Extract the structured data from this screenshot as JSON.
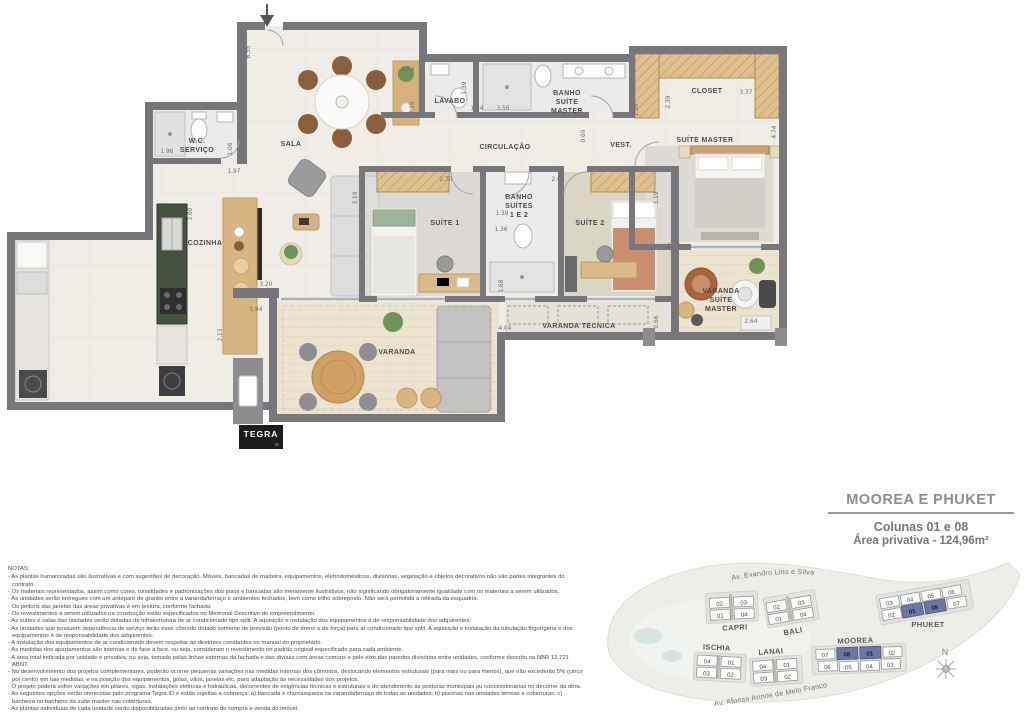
{
  "plan": {
    "labels": {
      "sala": "SALA",
      "wc1": "W.C.",
      "wc2": "SERVIÇO",
      "cozinha": "COZINHA",
      "lavabo": "LAVABO",
      "bm1": "BANHO",
      "bm2": "SUÍTE",
      "bm3": "MASTER",
      "closet": "CLOSET",
      "circ": "CIRCULAÇÃO",
      "vest": "VEST.",
      "sm": "SUÍTE MASTER",
      "s1": "SUÍTE 1",
      "s2": "SUÍTE 2",
      "bs1": "BANHO",
      "bs2": "SUÍTES",
      "bs3": "1 E 2",
      "varanda": "VARANDA",
      "vtec": "VARANDA TÉCNICA",
      "vsm1": "VARANDA",
      "vsm2": "SUÍTE",
      "vsm3": "MASTER"
    },
    "dims": [
      "6.35",
      "4.54",
      "2.39",
      "1.39",
      "1.34",
      "3.56",
      "1.36",
      "2.39",
      "3.37",
      "4.74",
      "1.96",
      "1.06",
      "1.97",
      "2.70",
      "2.69",
      "0.69",
      "3.19",
      "3.19",
      "1.39",
      "1.36",
      "1.68",
      "2.77",
      "3.60",
      "3.20",
      "5.94",
      "2.13",
      "1.84",
      "4.04",
      "0.66",
      "1.60",
      "2.64"
    ]
  },
  "logo": {
    "name": "TEGRA",
    "sub": "ID"
  },
  "title_block": {
    "title": "MOOREA E PHUKET",
    "line1": "Colunas 01 e 08",
    "line2": "Área privativa - 124,96m²"
  },
  "notes": {
    "heading": "NOTAS:",
    "items": [
      "- As plantas humanizadas são ilustrativas e com sugestões de decoração. Móveis, bancadas de madeira, equipamentos, eletrodomésticos, divisórias, vegetação e objetos decorativos não são partes integrantes do contrato.",
      "- Os materiais representados, assim como cores, tonalidades e padronizações dos pisos e bancadas são meramente ilustrativos, não significando obrigatoriamente igualdade com os materiais a serem utilizados.",
      "- As unidades serão entregues com um anteparo de granito entre a varanda/terraço e ambientes fechados, bem como trilho sobreposto. Não será permitida a retirada da esquadria.",
      "- Os peitoris das janelas das áreas privativas é em textura, conforme fachada.",
      "- Os revestimentos a serem utilizados na construção estão especificados no Memorial Descritivo do empreendimento.",
      "- As suítes e salas das unidades serão dotadas de infraestrutura de ar condicionado tipo split. A aquisição e instalação dos equipamentos é de responsabilidade dos adquirentes.",
      "- As unidades que possuem dependência de serviço terão esse cômodo dotado somente de previsão (ponto de dreno e de força) para ar condicionado tipo split. A aquisição e instalação da tubulação frigorígena e dos equipamentos é de responsabilidade dos adquirentes.",
      "- A instalação dos equipamentos de ar condicionado devem respeitar as diretrizes constantes no manual do proprietário.",
      "- As medidas dos apartamentos são internas e de face a face, ou seja, consideram o revestimento no padrão original especificado para cada ambiente.",
      "- A área total indicada por unidade é privativa, ou seja, tomada pelas linhas externas da fachada e das divisas com áreas comuns e pelo eixo das paredes divisórias entre unidades, conforme descrito na NBR 12.721 ABNT.",
      "- No desenvolvimento dos projetos complementares, poderão ocorrer pequenas variações nas medidas internas dos cômodos, deslocando elementos estruturais (para mais ou para menos), que não excederão 5% (cinco por cento) em tais medidas, e na posição dos equipamentos, golas, vãos, janelas etc, para adaptação às necessidades dos projetos.",
      "- O projeto poderá sofrer variações em pilares, vigas, instalações elétricas e hidráulicas, decorrentes de exigências técnicas e estruturais e do atendimento às posturas municipais ou concessionárias no decorrer da obra.",
      "- As seguintes opções serão oferecidas pelo programa Tegra ID e estão sujeitas a cobrança: a) bancada e churrasqueira na varanda/terraço de todas as unidades; b) piscinas nas unidades térreas e coberturas; c) banheira no banheiro da suíte master nas coberturas.",
      "- As plantas individuais de cada unidade serão disponibilizadas junto ao contrato de compra e venda do imóvel."
    ]
  },
  "map": {
    "street_top": "Av. Evandro Lins e Silva",
    "street_bottom": "Av. Afonso Arinos de Melo Franco",
    "compass": "N",
    "buildings": {
      "capri": {
        "name": "CAPRI",
        "units": [
          "02",
          "03",
          "01",
          "04"
        ]
      },
      "bali": {
        "name": "BALI",
        "units": [
          "02",
          "03",
          "01",
          "04"
        ]
      },
      "ischia": {
        "name": "ISCHIA",
        "units": [
          "04",
          "01",
          "03",
          "02"
        ]
      },
      "lanai": {
        "name": "LANAI",
        "units": [
          "04",
          "01",
          "03",
          "02"
        ]
      },
      "moorea": {
        "name": "MOOREA",
        "units": [
          "07",
          "08",
          "01",
          "02",
          "06",
          "05",
          "04",
          "03"
        ],
        "highlighted": [
          "08",
          "01"
        ]
      },
      "phuket": {
        "name": "PHUKET",
        "units": [
          "03",
          "04",
          "05",
          "06",
          "02",
          "01",
          "08",
          "07"
        ],
        "highlighted": [
          "01",
          "08"
        ]
      }
    }
  },
  "colors": {
    "wall": "#77777b",
    "highlight": "#6b76a2"
  }
}
